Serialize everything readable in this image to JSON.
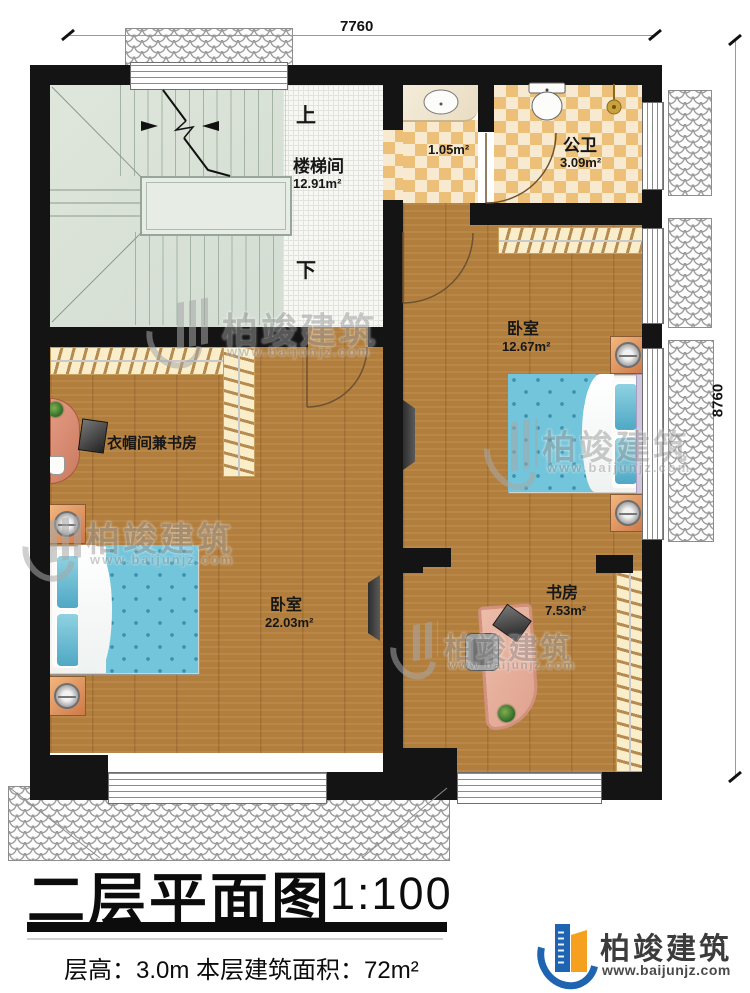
{
  "dimensions": {
    "top": "7760",
    "right": "8760"
  },
  "stairs": {
    "room": "楼梯间",
    "area": "12.91m²",
    "up": "上",
    "down": "下"
  },
  "rooms": {
    "corridor": {
      "area": "1.05m²"
    },
    "bathroom": {
      "name": "公卫",
      "area": "3.09m²"
    },
    "bedroom_right": {
      "name": "卧室",
      "area": "12.67m²"
    },
    "cloakroom": {
      "name": "衣帽间兼书房"
    },
    "bedroom_left": {
      "name": "卧室",
      "area": "22.03m²"
    },
    "study": {
      "name": "书房",
      "area": "7.53m²"
    }
  },
  "watermark": {
    "brand": "柏竣建筑",
    "site": "www.baijunjz.com"
  },
  "titleblock": {
    "title": "二层平面图",
    "scale": "1:100",
    "details": "层高：3.0m  本层建筑面积：72m²"
  },
  "logo": {
    "brand": "柏竣建筑",
    "site": "www.baijunjz.com"
  },
  "colors": {
    "wall": "#141414",
    "wood": "#b17e3e",
    "tile_dark": "#ecc078",
    "tile_light": "#f8ead0",
    "bed": "#72c5db",
    "accent_blue": "#1f64b0",
    "accent_orange": "#f5a01e"
  }
}
